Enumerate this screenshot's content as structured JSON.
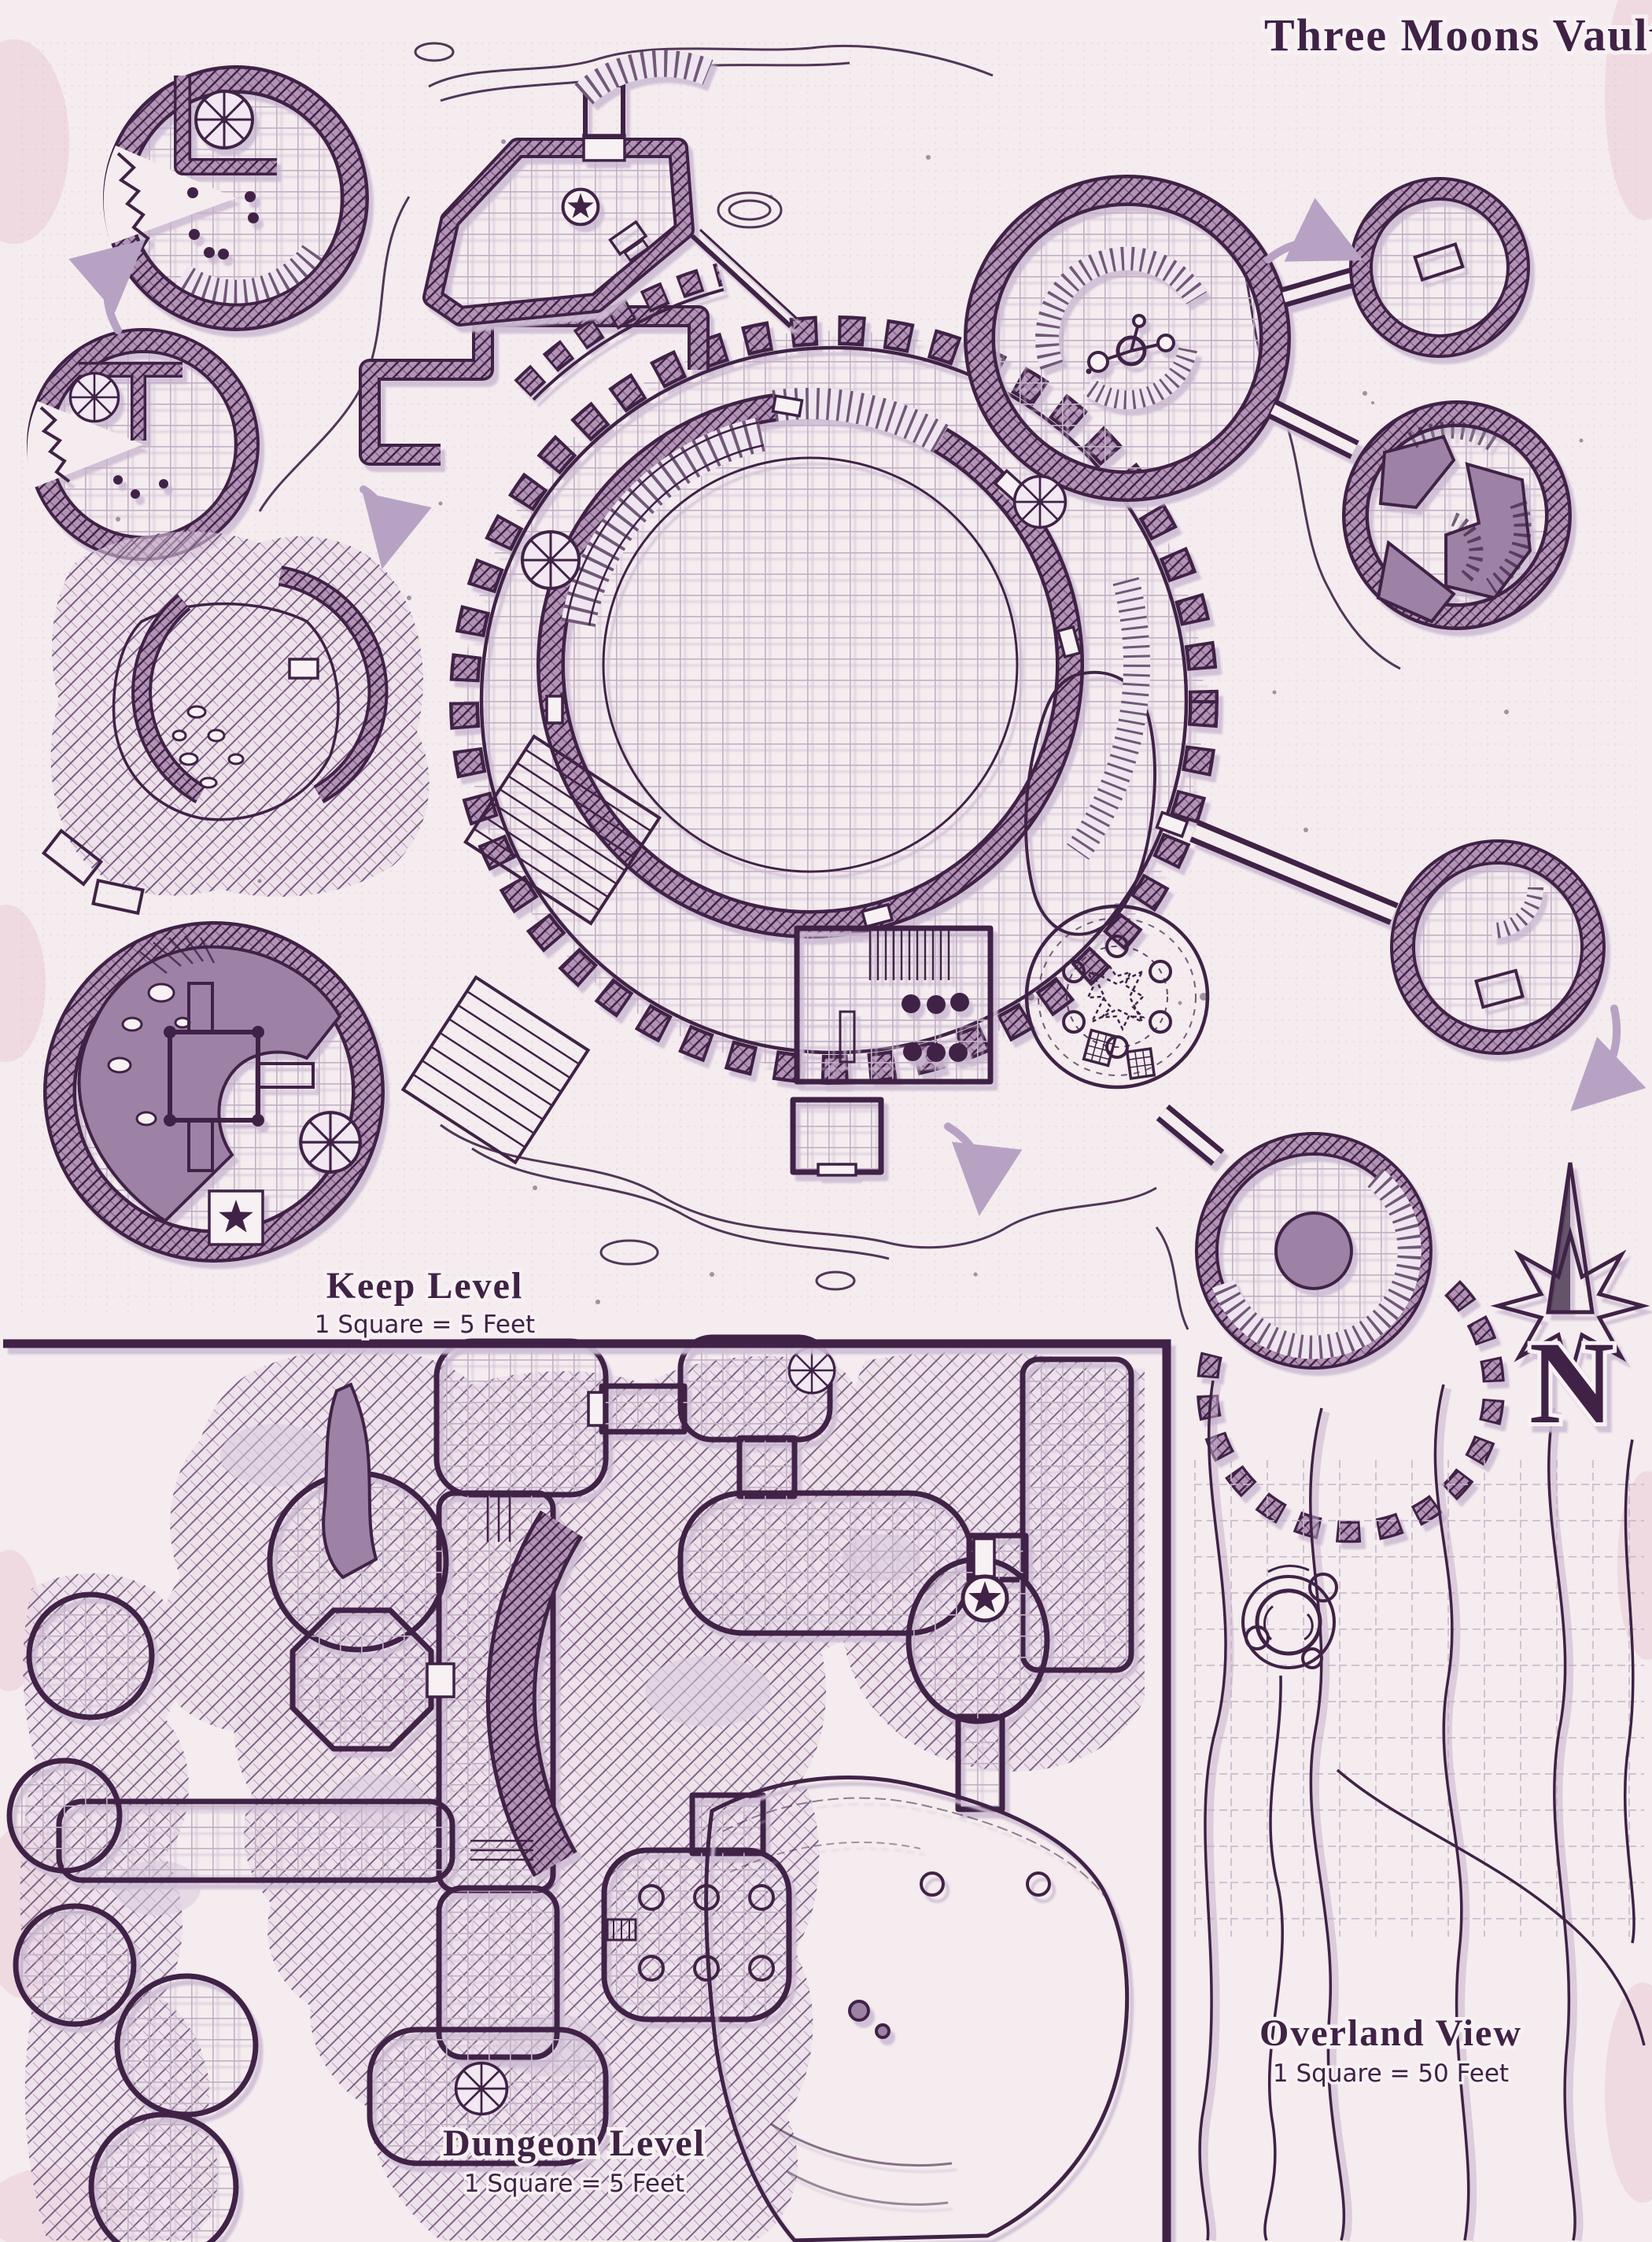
{
  "title": "Three Moons Vault",
  "compass": {
    "north_label": "N"
  },
  "sections": {
    "keep": {
      "label": "Keep Level",
      "scale": "1 Square = 5 Feet"
    },
    "dungeon": {
      "label": "Dungeon Level",
      "scale": "1 Square = 5 Feet"
    },
    "overland": {
      "label": "Overland View",
      "scale": "1 Square = 50 Feet"
    }
  },
  "colors": {
    "ink": "#3f2246",
    "wall": "#7e5c83",
    "wallbg": "#b293b6",
    "parch": "#f4ecee",
    "grid": "#c2b0c6",
    "mauve": "#9e82a6",
    "shadow": "#cfbdd4",
    "arrow": "#b7a2c4",
    "blush": "#eac8d4"
  }
}
